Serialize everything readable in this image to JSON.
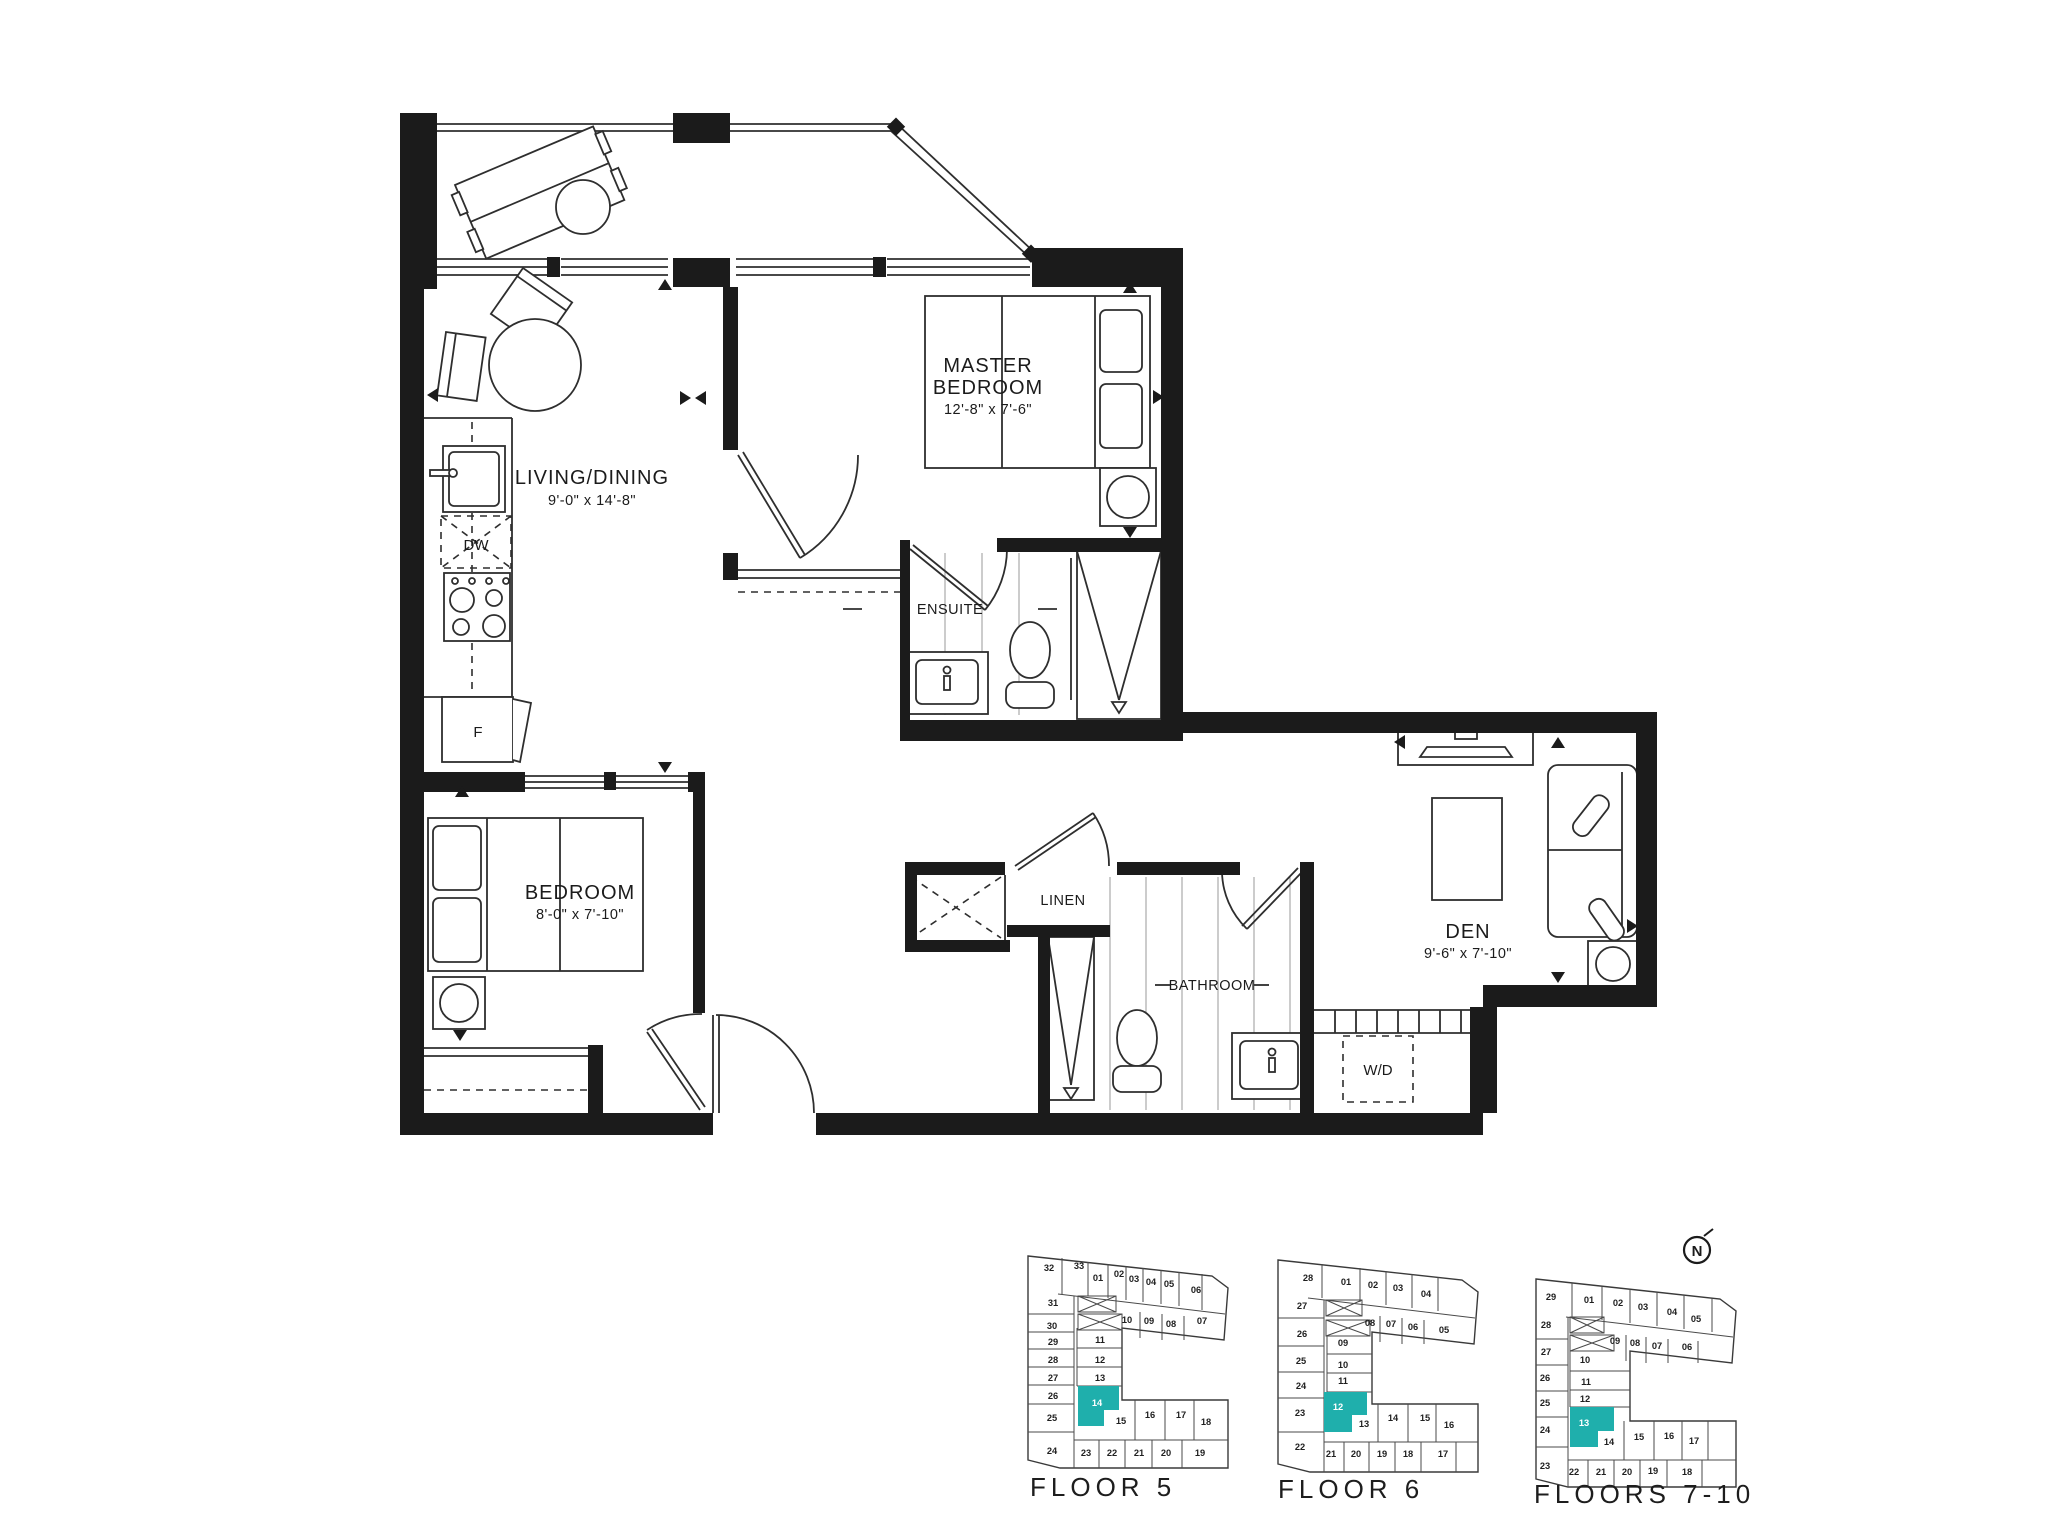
{
  "plan": {
    "rooms": {
      "living_dining": {
        "name": "LIVING/DINING",
        "dims": "9'-0\" x 14'-8\""
      },
      "master_bedroom": {
        "name_line1": "MASTER",
        "name_line2": "BEDROOM",
        "dims": "12'-8\" x 7'-6\""
      },
      "bedroom": {
        "name": "BEDROOM",
        "dims": "8'-0\" x 7'-10\""
      },
      "den": {
        "name": "DEN",
        "dims": "9'-6\" x 7'-10\""
      },
      "ensuite": {
        "name": "ENSUITE"
      },
      "bathroom": {
        "name": "BATHROOM"
      },
      "linen": {
        "name": "LINEN"
      },
      "laundry": {
        "name": "W/D"
      },
      "dishwasher": {
        "name": "DW"
      },
      "fridge": {
        "name": "F"
      }
    }
  },
  "keyplans": {
    "floor5": {
      "label": "FLOOR 5",
      "highlighted_unit": "14",
      "units": [
        "32",
        "33",
        "01",
        "02",
        "03",
        "04",
        "05",
        "06",
        "31",
        "30",
        "10",
        "09",
        "08",
        "07",
        "29",
        "11",
        "28",
        "12",
        "27",
        "13",
        "26",
        "14",
        "25",
        "15",
        "16",
        "17",
        "18",
        "24",
        "23",
        "22",
        "21",
        "20",
        "19"
      ]
    },
    "floor6": {
      "label": "FLOOR 6",
      "highlighted_unit": "12",
      "units": [
        "28",
        "01",
        "02",
        "03",
        "04",
        "27",
        "08",
        "07",
        "06",
        "05",
        "26",
        "09",
        "25",
        "10",
        "24",
        "11",
        "23",
        "12",
        "13",
        "14",
        "15",
        "16",
        "22",
        "21",
        "20",
        "19",
        "18",
        "17"
      ]
    },
    "floors7_10": {
      "label": "FLOORS 7-10",
      "highlighted_unit": "13",
      "units": [
        "29",
        "01",
        "02",
        "03",
        "04",
        "05",
        "28",
        "09",
        "08",
        "07",
        "06",
        "27",
        "10",
        "26",
        "11",
        "25",
        "12",
        "24",
        "13",
        "14",
        "15",
        "16",
        "17",
        "23",
        "22",
        "21",
        "20",
        "19",
        "18"
      ]
    }
  },
  "north": {
    "label": "N"
  },
  "colors": {
    "wall": "#1b1b1b",
    "line": "#2e2e2e",
    "highlight": "#1FAFAC"
  }
}
